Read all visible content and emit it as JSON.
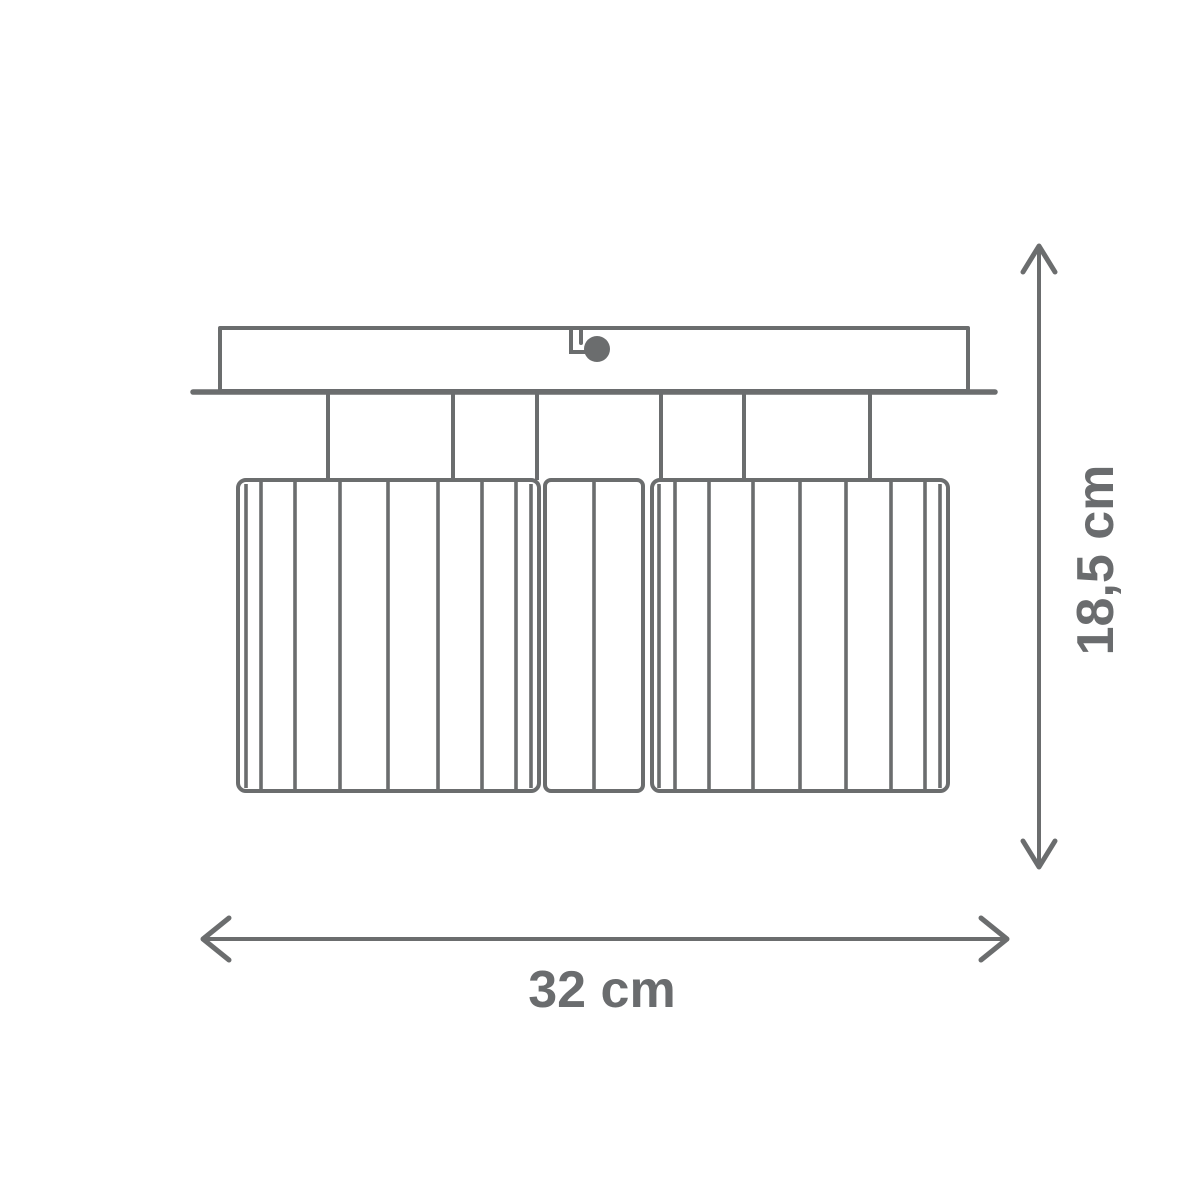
{
  "diagram": {
    "type": "product-dimension-drawing",
    "subject": "ceiling-lamp-front-view",
    "dimensions": {
      "width": {
        "label": "32 cm",
        "value": 32,
        "unit": "cm",
        "orientation": "horizontal"
      },
      "height": {
        "label": "18,5 cm",
        "value": 18.5,
        "unit": "cm",
        "orientation": "vertical"
      }
    },
    "colors": {
      "line": "#6b6d6e",
      "text": "#6a6c6e",
      "background": "#ffffff"
    }
  }
}
